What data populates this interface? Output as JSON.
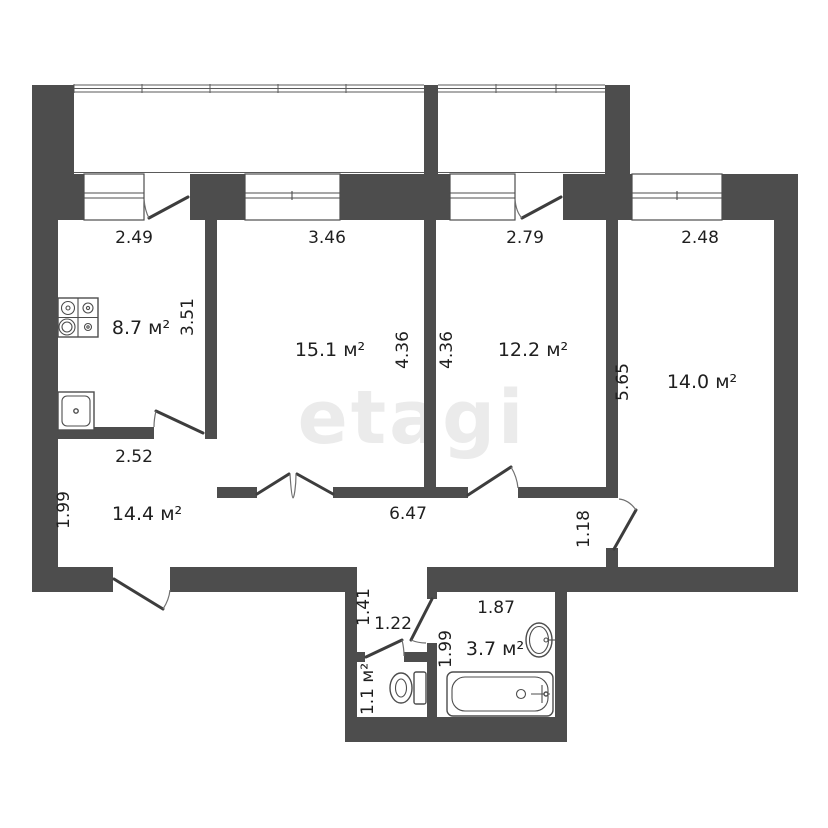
{
  "watermark": "etagi",
  "colors": {
    "wall": "#4d4d4d",
    "text": "#1f1f1f",
    "watermark": "#ebebeb",
    "background": "#ffffff"
  },
  "rooms": {
    "kitchen": "8.7 м²",
    "room1": "15.1 м²",
    "room2": "12.2 м²",
    "room3": "14.0 м²",
    "hall": "14.4 м²",
    "wc": "1.1 м²",
    "bathroom": "3.7 м²"
  },
  "dims": {
    "kitchen_w": "2.49",
    "room1_w": "3.46",
    "room2_w": "2.79",
    "room3_w": "2.48",
    "kitchen_h": "3.51",
    "room1_h": "4.36",
    "room2_h": "4.36",
    "room3_h": "5.65",
    "hall_top": "2.52",
    "hall_left": "1.99",
    "hall_w": "6.47",
    "room3_door": "1.18",
    "niche_depth": "1.41",
    "niche_w": "1.22",
    "bath_w": "1.87",
    "bath_h": "1.99"
  },
  "fixtures": [
    "stove-icon",
    "kitchen-sink-icon",
    "toilet-icon",
    "bathroom-sink-icon",
    "bathtub-icon"
  ]
}
